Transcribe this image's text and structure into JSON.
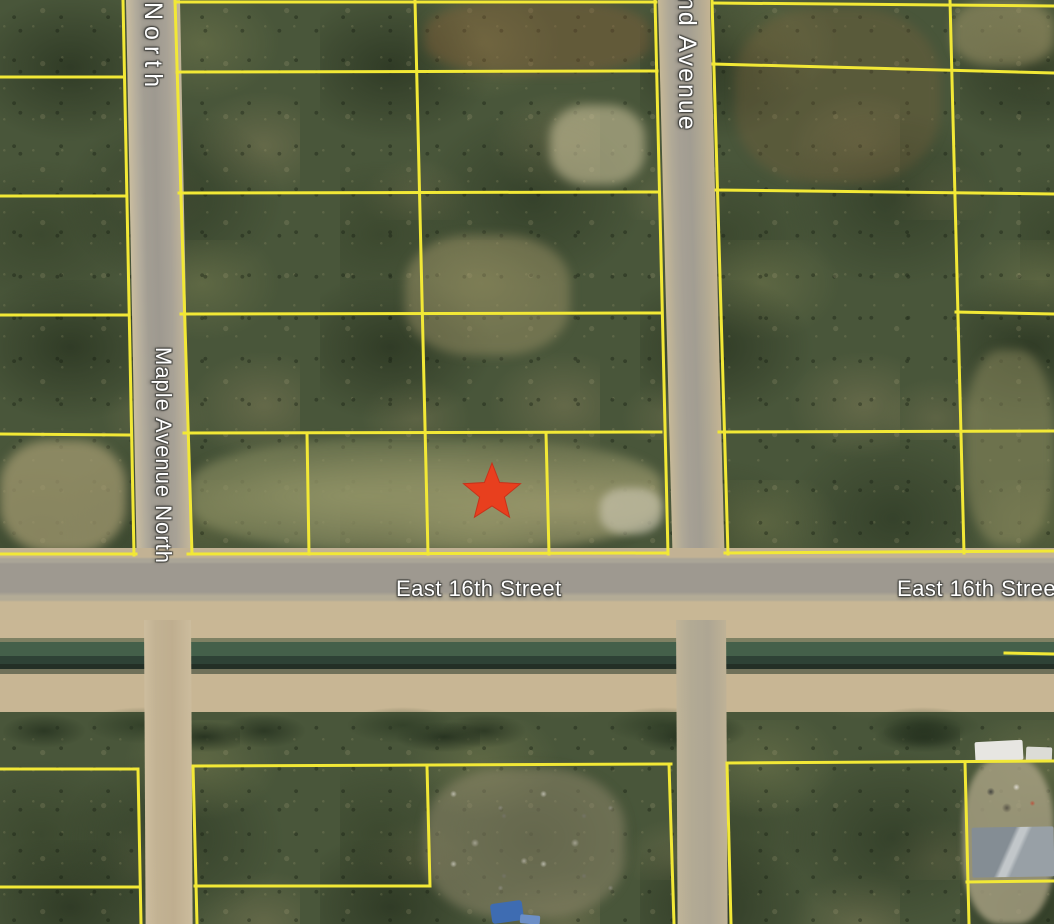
{
  "map": {
    "type": "satellite parcel map with lot boundaries",
    "marker": {
      "shape": "star",
      "color": "#e83f1e"
    },
    "colors": {
      "parcel_line": "#f2e836",
      "label_text": "#ffffff"
    },
    "labels": {
      "top_road_partial": "North",
      "left_road": "Maple Avenue North",
      "right_road_partial": "nd Avenue",
      "bottom_road": "East 16th Street",
      "bottom_road_right_partial": "East 16th Stree"
    }
  }
}
